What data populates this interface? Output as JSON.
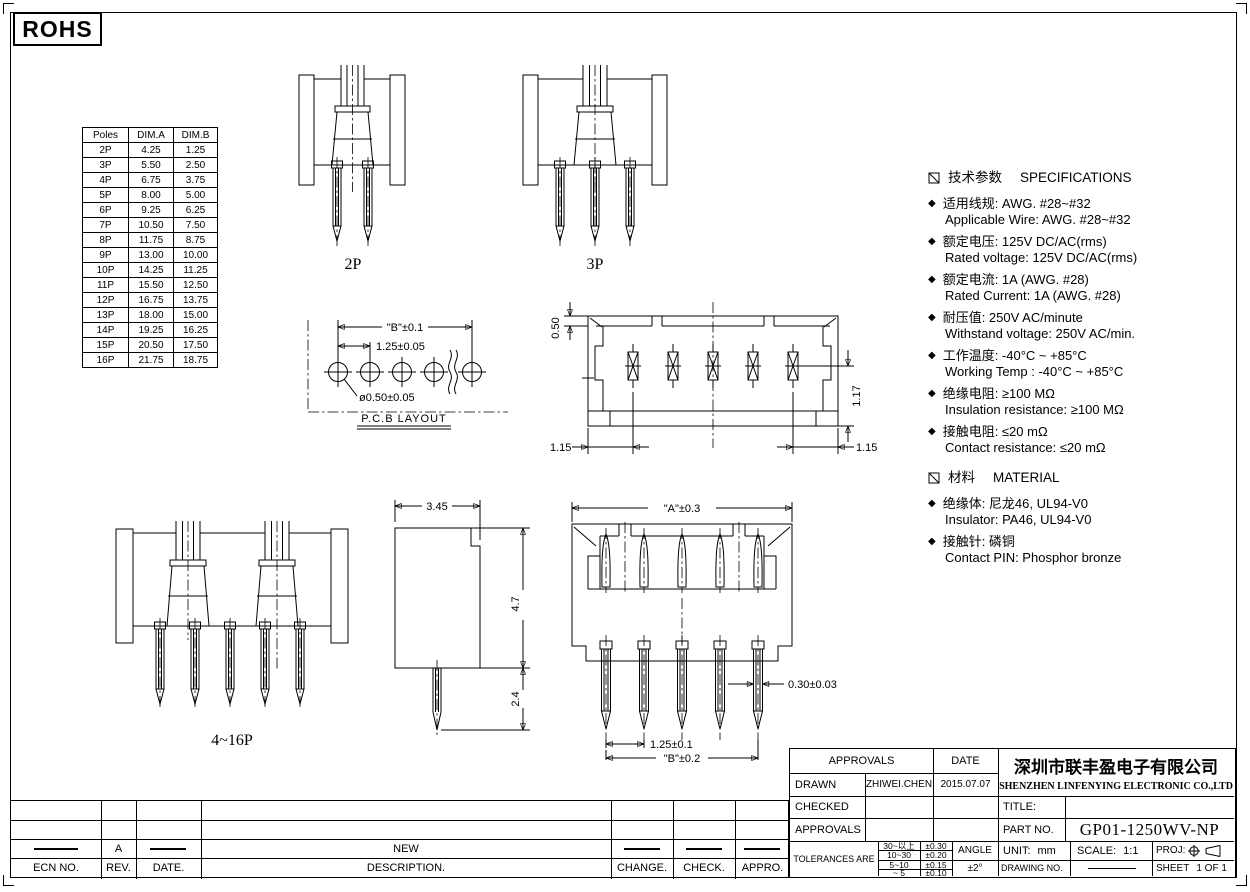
{
  "rohs_label": "ROHS",
  "icons": {
    "bullet": "◆"
  },
  "poles_table": {
    "headers": [
      "Poles",
      "DIM.A",
      "DIM.B"
    ],
    "rows": [
      [
        "2P",
        "4.25",
        "1.25"
      ],
      [
        "3P",
        "5.50",
        "2.50"
      ],
      [
        "4P",
        "6.75",
        "3.75"
      ],
      [
        "5P",
        "8.00",
        "5.00"
      ],
      [
        "6P",
        "9.25",
        "6.25"
      ],
      [
        "7P",
        "10.50",
        "7.50"
      ],
      [
        "8P",
        "11.75",
        "8.75"
      ],
      [
        "9P",
        "13.00",
        "10.00"
      ],
      [
        "10P",
        "14.25",
        "11.25"
      ],
      [
        "11P",
        "15.50",
        "12.50"
      ],
      [
        "12P",
        "16.75",
        "13.75"
      ],
      [
        "13P",
        "18.00",
        "15.00"
      ],
      [
        "14P",
        "19.25",
        "16.25"
      ],
      [
        "15P",
        "20.50",
        "17.50"
      ],
      [
        "16P",
        "21.75",
        "18.75"
      ]
    ]
  },
  "views": {
    "label_2p": "2P",
    "label_3p": "3P",
    "label_416p": "4~16P",
    "pcb": {
      "span": "\"B\"±0.1",
      "pitch": "1.25±0.05",
      "hole": "ø0.50±0.05",
      "caption": "P.C.B LAYOUT"
    },
    "top": {
      "depth": "0.50",
      "height": "1.17",
      "left": "1.15",
      "right": "1.15"
    },
    "side": {
      "width": "3.45",
      "body": "4.7",
      "pin": "2.4"
    },
    "front": {
      "a": "\"A\"±0.3",
      "pin_w": "0.30±0.03",
      "pitch": "1.25±0.1",
      "b": "\"B\"±0.2"
    }
  },
  "specs": {
    "header_zh": "技术参数",
    "header_en": "SPECIFICATIONS",
    "items": [
      {
        "zh": "适用线规: AWG. #28~#32",
        "en": "Applicable Wire: AWG. #28~#32"
      },
      {
        "zh": "额定电压: 125V DC/AC(rms)",
        "en": "Rated voltage: 125V DC/AC(rms)"
      },
      {
        "zh": "额定电流: 1A (AWG. #28)",
        "en": "Rated Current: 1A (AWG. #28)"
      },
      {
        "zh": "耐压值: 250V AC/minute",
        "en": "Withstand voltage: 250V AC/min."
      },
      {
        "zh": "工作温度: -40°C ~ +85°C",
        "en": "Working Temp : -40°C ~ +85°C"
      },
      {
        "zh": "绝缘电阻: ≥100 MΩ",
        "en": "Insulation resistance: ≥100 MΩ"
      },
      {
        "zh": "接触电阻: ≤20 mΩ",
        "en": "Contact resistance: ≤20 mΩ"
      }
    ],
    "material_header_zh": "材料",
    "material_header_en": "MATERIAL",
    "material_items": [
      {
        "zh": "绝缘体: 尼龙46, UL94-V0",
        "en": "Insulator: PA46, UL94-V0"
      },
      {
        "zh": "接触针: 磷铜",
        "en": "Contact PIN: Phosphor bronze"
      }
    ]
  },
  "title_block": {
    "approvals_header": "APPROVALS",
    "date_header": "DATE",
    "drawn_label": "DRAWN",
    "drawn_name": "ZHIWEI.CHEN",
    "drawn_date": "2015.07.07",
    "checked_label": "CHECKED",
    "approvals_label": "APPROVALS",
    "tolerances_label": "TOLERANCES ARE",
    "tolerances": [
      {
        "range": "30~以上",
        "value": "±0.30"
      },
      {
        "range": "10~30",
        "value": "±0.20"
      },
      {
        "range": "5~10",
        "value": "±0.15"
      },
      {
        "range": "~ 5",
        "value": "±0.10"
      }
    ],
    "angle_label": "ANGLE",
    "angle_value": "±2°",
    "company_zh": "深圳市联丰盈电子有限公司",
    "company_en": "SHENZHEN LINFENYING ELECTRONIC CO.,LTD",
    "title_label": "TITLE:",
    "part_no_label": "PART NO.",
    "part_no": "GP01-1250WV-NP",
    "unit_label": "UNIT:",
    "unit_value": "mm",
    "scale_label": "SCALE:",
    "scale_value": "1:1",
    "proj_label": "PROJ:",
    "drawing_no_label": "DRAWING NO.",
    "sheet_label": "SHEET",
    "sheet_value": "1 OF 1"
  },
  "revision": {
    "headers": [
      "ECN NO.",
      "REV.",
      "DATE.",
      "DESCRIPTION.",
      "CHANGE.",
      "CHECK.",
      "APPRO."
    ],
    "row": {
      "rev": "A",
      "description": "NEW"
    }
  },
  "colors": {
    "line": "#000000",
    "background": "#ffffff"
  }
}
